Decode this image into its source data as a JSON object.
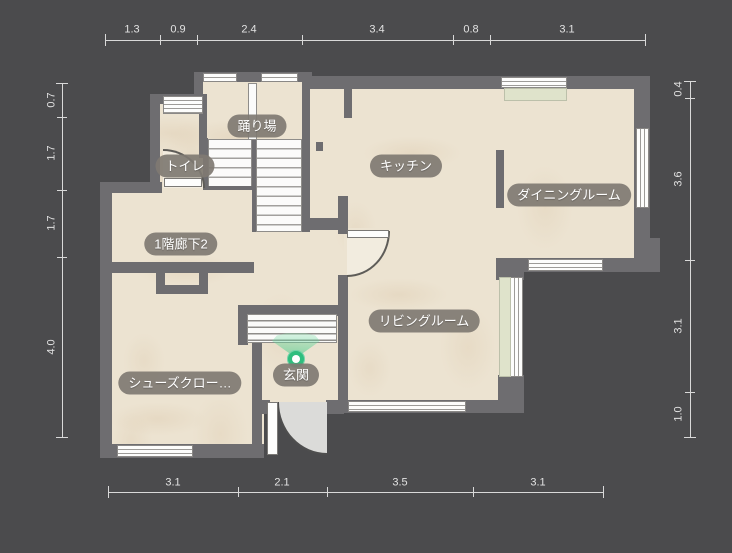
{
  "app": {
    "type": "floor-plan-viewer",
    "floor": "1F"
  },
  "colors": {
    "background": "#4b4b4d",
    "wall": "#6e6d70",
    "floor": "#ece3d1",
    "label_pill": "#7f7a72",
    "label_text": "#ffffff",
    "dimension_text": "#e2e2e2",
    "entrance_marker_green": "#2fbe7e",
    "counter_green": "#dfe3cb"
  },
  "rooms": [
    {
      "id": "odoriba",
      "label": "踊り場"
    },
    {
      "id": "toilet",
      "label": "トイレ"
    },
    {
      "id": "kitchen",
      "label": "キッチン"
    },
    {
      "id": "dining",
      "label": "ダイニングルーム"
    },
    {
      "id": "hallway_1f_2",
      "label": "1階廊下2"
    },
    {
      "id": "living",
      "label": "リビングルーム"
    },
    {
      "id": "shoes_closet",
      "label": "シューズクロー…"
    },
    {
      "id": "genkan",
      "label": "玄関"
    }
  ],
  "dimensions": {
    "top": [
      "1.3",
      "0.9",
      "2.4",
      "3.4",
      "0.8",
      "3.1"
    ],
    "bottom": [
      "3.1",
      "2.1",
      "3.5",
      "3.1"
    ],
    "left": [
      "0.7",
      "1.7",
      "1.7",
      "4.0"
    ],
    "right": [
      "0.4",
      "3.6",
      "3.1",
      "1.0"
    ]
  },
  "entrance_marker": {
    "type": "entrance-direction-pin"
  }
}
